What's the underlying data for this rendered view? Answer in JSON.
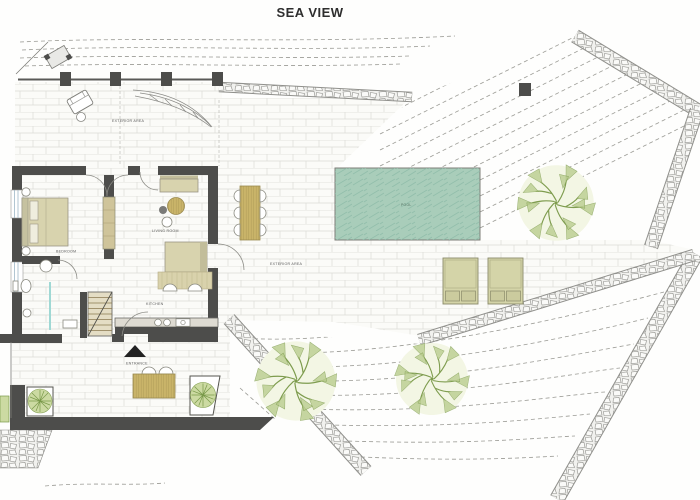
{
  "title": "SEA VIEW",
  "plan": {
    "labels": {
      "exterior_area_top": "EXTERIOR AREA",
      "exterior_area_main": "EXTERIOR AREA",
      "bedroom": "BEDROOM",
      "living_room": "LIVING ROOM",
      "kitchen": "KITCHEN",
      "entrance": "ENTRANCE",
      "pool": "POOL"
    },
    "colors": {
      "wall_dark": "#4d4d4b",
      "paving_line": "#dcdcd6",
      "contour": "#9b9b95",
      "pool_fill": "#a9cdba",
      "pool_hatch": "#8fbca9",
      "furniture_tan": "#d8d3ae",
      "wood": "#c9b469",
      "tree_green": "#7e9c4e",
      "tree_fill": "#f3f6e4",
      "planter_green": "#ccdaa2",
      "stone_edge": "#90908c",
      "glass_teal": "#9fd8d4",
      "label_ink": "#5a5a5a"
    }
  }
}
